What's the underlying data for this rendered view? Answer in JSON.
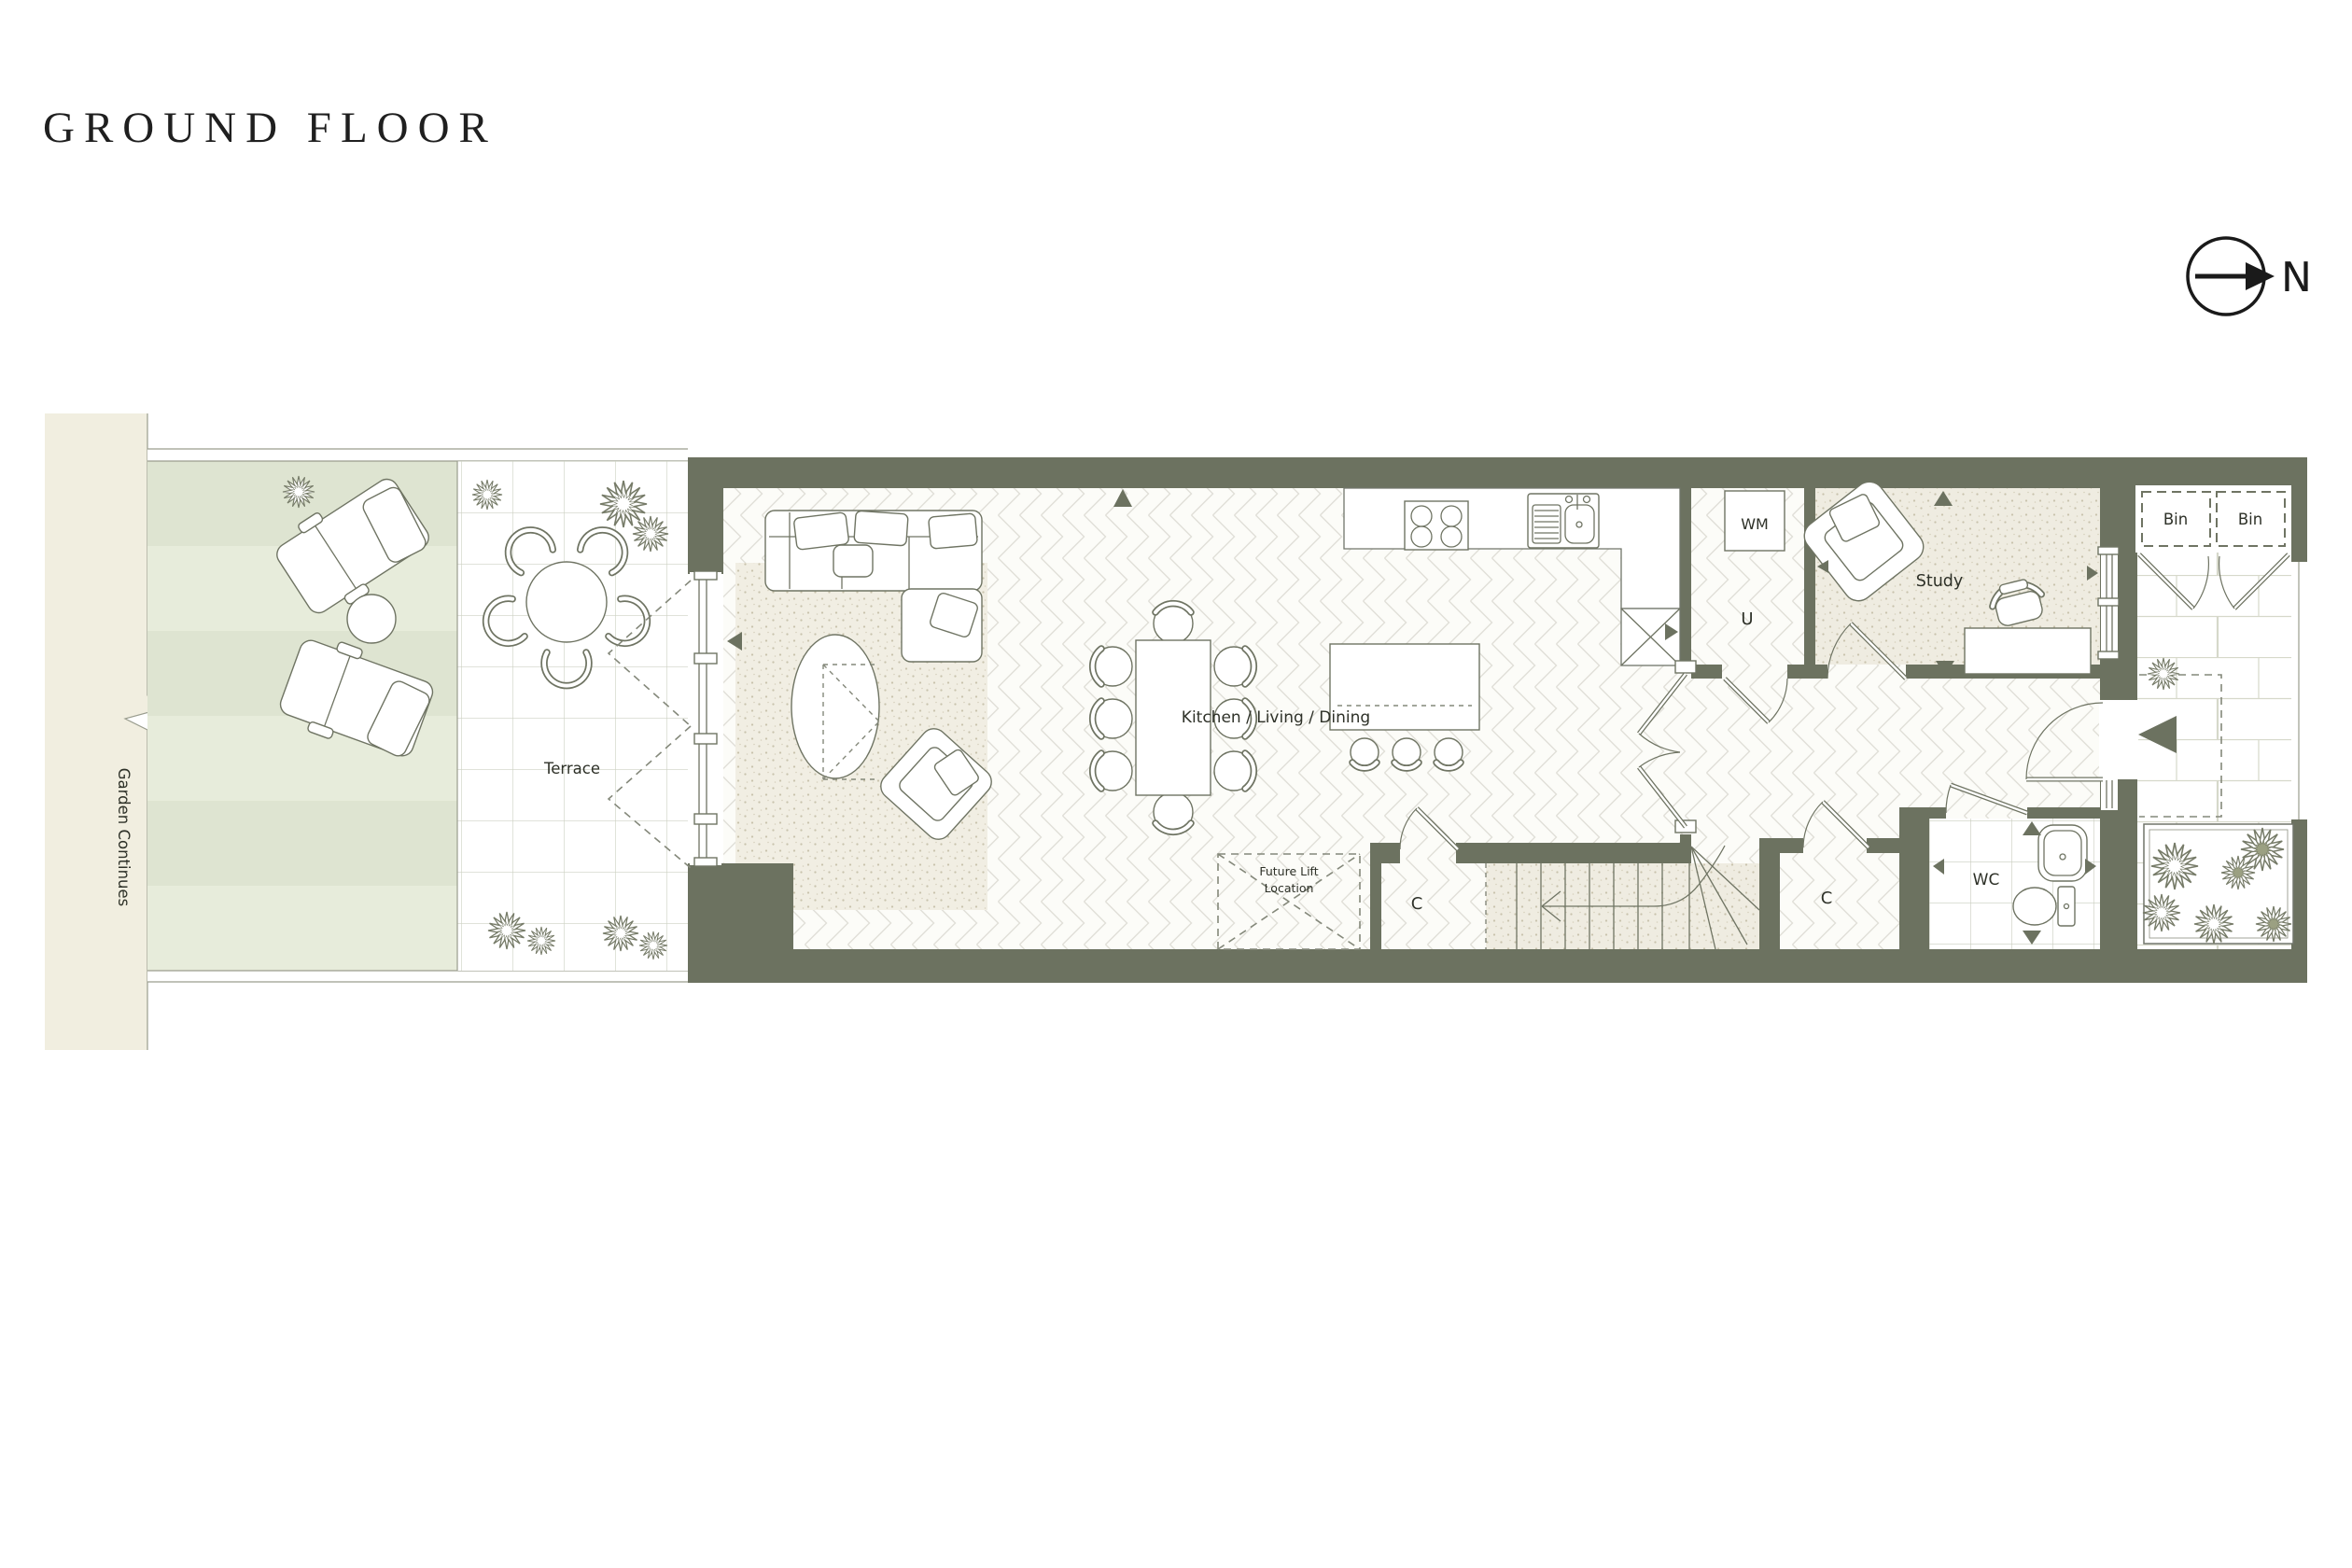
{
  "page": {
    "title": "GROUND FLOOR"
  },
  "compass": {
    "label": "N"
  },
  "plan": {
    "garden": {
      "label": "Garden Continues"
    },
    "terrace": {
      "label": "Terrace"
    },
    "main_room": {
      "label": "Kitchen / Living / Dining"
    },
    "utility": {
      "label": "U",
      "wm_label": "WM"
    },
    "study": {
      "label": "Study"
    },
    "closet_stairs": {
      "label": "C"
    },
    "closet_hall": {
      "label": "C"
    },
    "wc": {
      "label": "WC"
    },
    "bins": {
      "bin1": "Bin",
      "bin2": "Bin"
    },
    "future_lift": {
      "line1": "Future Lift",
      "line2": "Location"
    }
  },
  "colors": {
    "wall": "#6c7260",
    "beige_strip": "#f1eee0",
    "garden_stripe_dark": "#dee4d1",
    "garden_stripe_light": "#e7ecdb",
    "floor_stipple": "#efece1",
    "line": "#6f7463",
    "ink": "#2e3128"
  }
}
